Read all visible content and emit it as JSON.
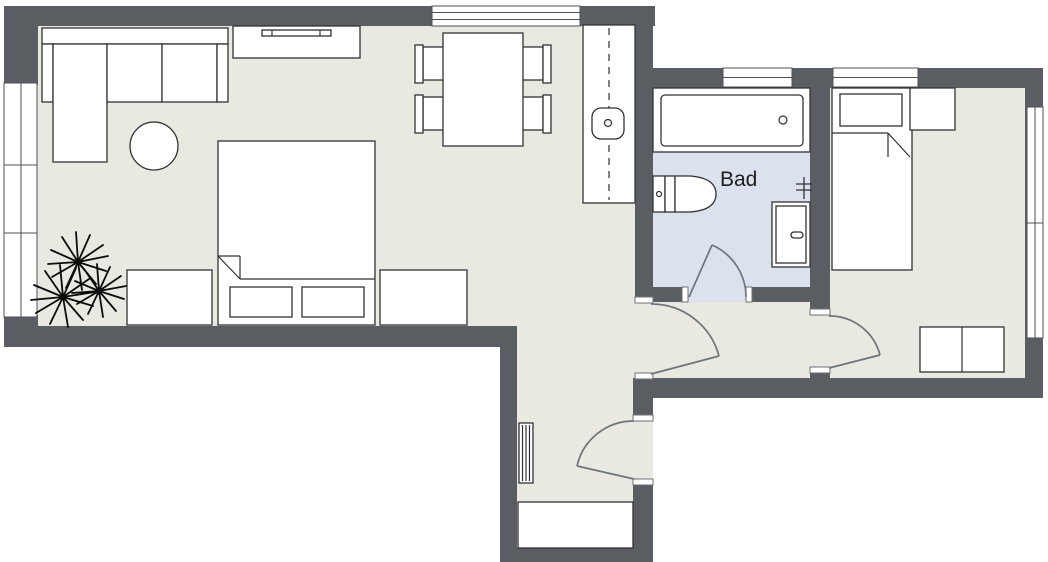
{
  "floorplan": {
    "rooms": {
      "bathroom": {
        "label": "Bad"
      }
    },
    "colors": {
      "wall": "#5a5e63",
      "floor": "#e9e9e1",
      "bathroom_floor": "#dbe1ed",
      "furniture_fill": "#ffffff",
      "outline": "#323232",
      "door_swing": "#6f747a",
      "plant": "#0b0b0b",
      "background": "#ffffff"
    },
    "furniture": {
      "living_room": [
        "corner-sofa",
        "round-side-table",
        "sideboard",
        "plant",
        "double-bed",
        "dresser",
        "dresser",
        "dining-table",
        "chair",
        "chair",
        "chair",
        "chair",
        "kitchen-counter",
        "sink"
      ],
      "bathroom": [
        "bathtub",
        "toilet",
        "towel-radiator",
        "cabinet"
      ],
      "bedroom": [
        "single-bed",
        "nightstand",
        "wardrobe"
      ],
      "hallway": [
        "radiator",
        "cabinet"
      ]
    },
    "doors": [
      "bathroom-door",
      "hallway-door",
      "bedroom-door",
      "entry-door"
    ],
    "windows": [
      "left-window",
      "top-window",
      "bathroom-top-window",
      "bedroom-top-window",
      "bedroom-right-window"
    ]
  }
}
